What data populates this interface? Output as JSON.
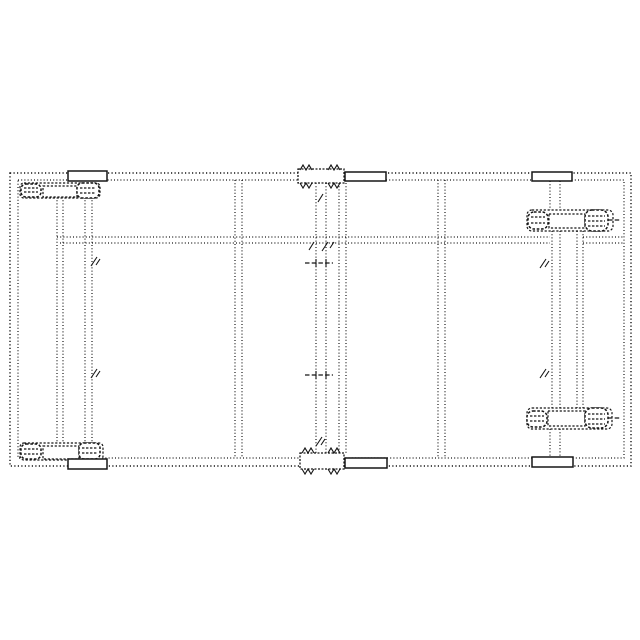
{
  "page": {
    "paper_color": "#ffffff",
    "ink_color": "#161616"
  },
  "diagram": {
    "type": "technical-line-drawing",
    "style": "dotted phantom outline, patent-figure style, no text or labels visible",
    "view": "top plan view of a rectangular wheeled frame chassis",
    "components": [
      {
        "name": "frame-outer-rail",
        "count": 1
      },
      {
        "name": "frame-inner-rail",
        "count": 1
      },
      {
        "name": "cross-member-left",
        "count": 1
      },
      {
        "name": "cross-member-right",
        "count": 1
      },
      {
        "name": "center-rail-horizontal",
        "count": 1
      },
      {
        "name": "left-wheel-carriage",
        "count": 1
      },
      {
        "name": "right-wheel-carriage",
        "count": 1
      },
      {
        "name": "center-folding-post",
        "count": 1
      },
      {
        "name": "wheel-assembly",
        "count": 4
      },
      {
        "name": "tire",
        "count": 8
      },
      {
        "name": "axle-plate",
        "count": 4
      },
      {
        "name": "mount-lug",
        "count": 6
      },
      {
        "name": "jagged-mount-pad",
        "count": 2
      },
      {
        "name": "pivot-pin",
        "count": 2
      },
      {
        "name": "hatch-tick",
        "count": 6
      }
    ]
  }
}
